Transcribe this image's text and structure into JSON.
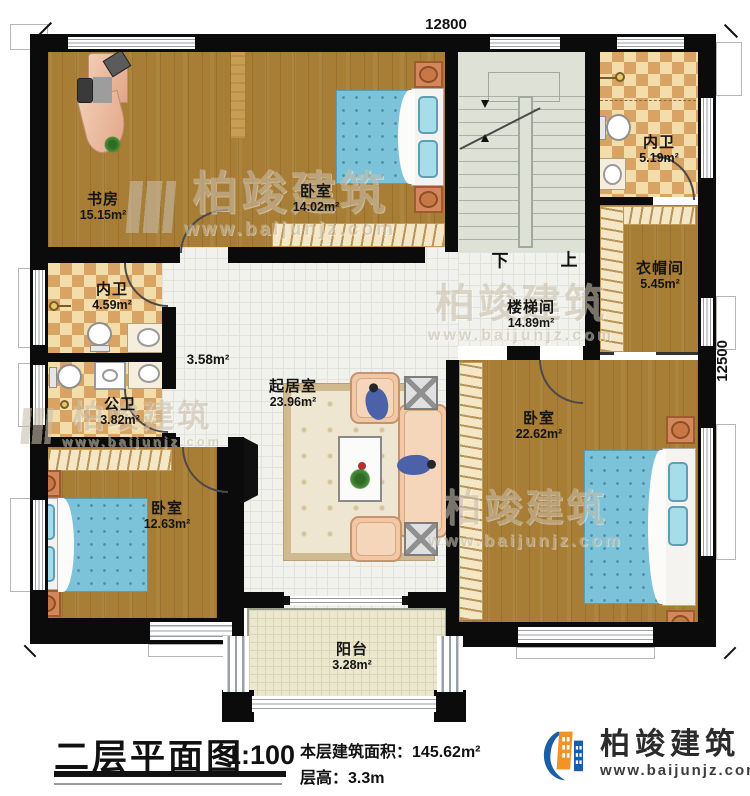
{
  "plan": {
    "dimensions": {
      "width_label": "12800",
      "height_label": "12500"
    },
    "stairs": {
      "down": "下",
      "up": "上"
    },
    "rooms": {
      "study": {
        "name": "书房",
        "area": "15.15m²"
      },
      "bedroom_top": {
        "name": "卧室",
        "area": "14.02m²"
      },
      "stairwell": {
        "name": "楼梯间",
        "area": "14.89m²"
      },
      "ensuite_bath_right": {
        "name": "内卫",
        "area": "5.19m²"
      },
      "cloakroom": {
        "name": "衣帽间",
        "area": "5.45m²"
      },
      "ensuite_bath_left": {
        "name": "内卫",
        "area": "4.59m²"
      },
      "public_bath": {
        "name": "公卫",
        "area": "3.82m²"
      },
      "hallway": {
        "area": "3.58m²"
      },
      "living_room": {
        "name": "起居室",
        "area": "23.96m²"
      },
      "bedroom_left": {
        "name": "卧室",
        "area": "12.63m²"
      },
      "bedroom_right": {
        "name": "卧室",
        "area": "22.62m²"
      },
      "balcony": {
        "name": "阳台",
        "area": "3.28m²"
      }
    }
  },
  "title_block": {
    "title": "二层平面图",
    "scale": "1:100",
    "area_label": "本层建筑面积：",
    "area_value": "145.62m²",
    "height_label": "层高：",
    "height_value": "3.3m"
  },
  "brand": {
    "name": "柏竣建筑",
    "website": "www.baijunjz.com"
  },
  "watermark": {
    "name": "柏竣建筑",
    "website": "www.baijunjz.com"
  },
  "colors": {
    "wall": "#0b0b0b",
    "wood_floor": "#a87d36",
    "checker_light": "#f3ddab",
    "checker_dark": "#d9a463",
    "stair_floor": "#dde1d6",
    "tile_floor": "#f1f2ed",
    "balcony_floor": "#ebe8cf",
    "bed_blue": "#7cc2d8",
    "sofa_peach": "#f1c7a5",
    "logo_blue": "#1b5ea6",
    "logo_orange": "#f39324",
    "watermark_gray": "#c8bfab"
  }
}
